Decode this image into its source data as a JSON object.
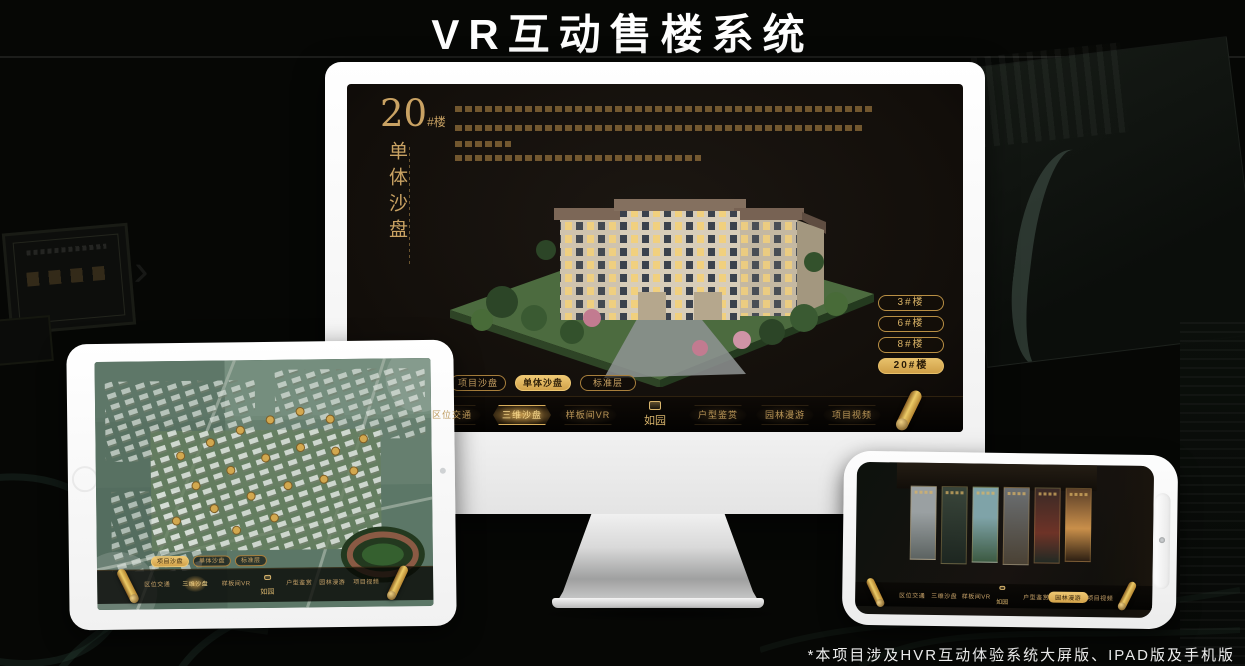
{
  "page": {
    "title": "VR互动售楼系统",
    "footnote": "*本项目涉及HVR互动体验系统大屏版、IPAD版及手机版"
  },
  "colors": {
    "gold": "#C9A263",
    "gold_bright": "#EEC873",
    "gold_fill": "#D2A24A",
    "screen_bg": "#16110D",
    "nav_text": "#C9A46A",
    "title_text": "#FFFFFF"
  },
  "monitor_app": {
    "unit_number": "20",
    "unit_suffix": "#楼",
    "unit_subtitle": "单体沙盘",
    "floor_buttons": [
      {
        "label": "3#楼",
        "active": false
      },
      {
        "label": "6#楼",
        "active": false
      },
      {
        "label": "8#楼",
        "active": false
      },
      {
        "label": "20#楼",
        "active": true
      }
    ],
    "subtabs": [
      {
        "label": "项目沙盘",
        "active": false
      },
      {
        "label": "单体沙盘",
        "active": true
      },
      {
        "label": "标准层",
        "active": false
      }
    ],
    "logo": "如园",
    "nav_items": [
      {
        "label": "区位交通",
        "active": false
      },
      {
        "label": "三维沙盘",
        "active": true
      },
      {
        "label": "样板间VR",
        "active": false
      },
      {
        "label": "户型鉴赏",
        "active": false
      },
      {
        "label": "园林漫游",
        "active": false
      },
      {
        "label": "项目视频",
        "active": false
      }
    ]
  },
  "tablet_app": {
    "subtabs": [
      {
        "label": "项目沙盘",
        "active": true
      },
      {
        "label": "单体沙盘",
        "active": false
      },
      {
        "label": "标准层",
        "active": false
      }
    ],
    "logo": "如园",
    "nav_items": [
      {
        "label": "区位交通",
        "active": false
      },
      {
        "label": "三维沙盘",
        "active": true
      },
      {
        "label": "样板间VR",
        "active": false
      },
      {
        "label": "户型鉴赏",
        "active": false
      },
      {
        "label": "园林漫游",
        "active": false
      },
      {
        "label": "项目视频",
        "active": false
      }
    ]
  },
  "phone_app": {
    "logo": "如园",
    "nav_items": [
      {
        "label": "区位交通",
        "active": false
      },
      {
        "label": "三维沙盘",
        "active": false
      },
      {
        "label": "样板间VR",
        "active": false
      },
      {
        "label": "户型鉴赏",
        "active": false
      },
      {
        "label": "园林漫游",
        "active": true
      },
      {
        "label": "项目视频",
        "active": false
      }
    ]
  }
}
